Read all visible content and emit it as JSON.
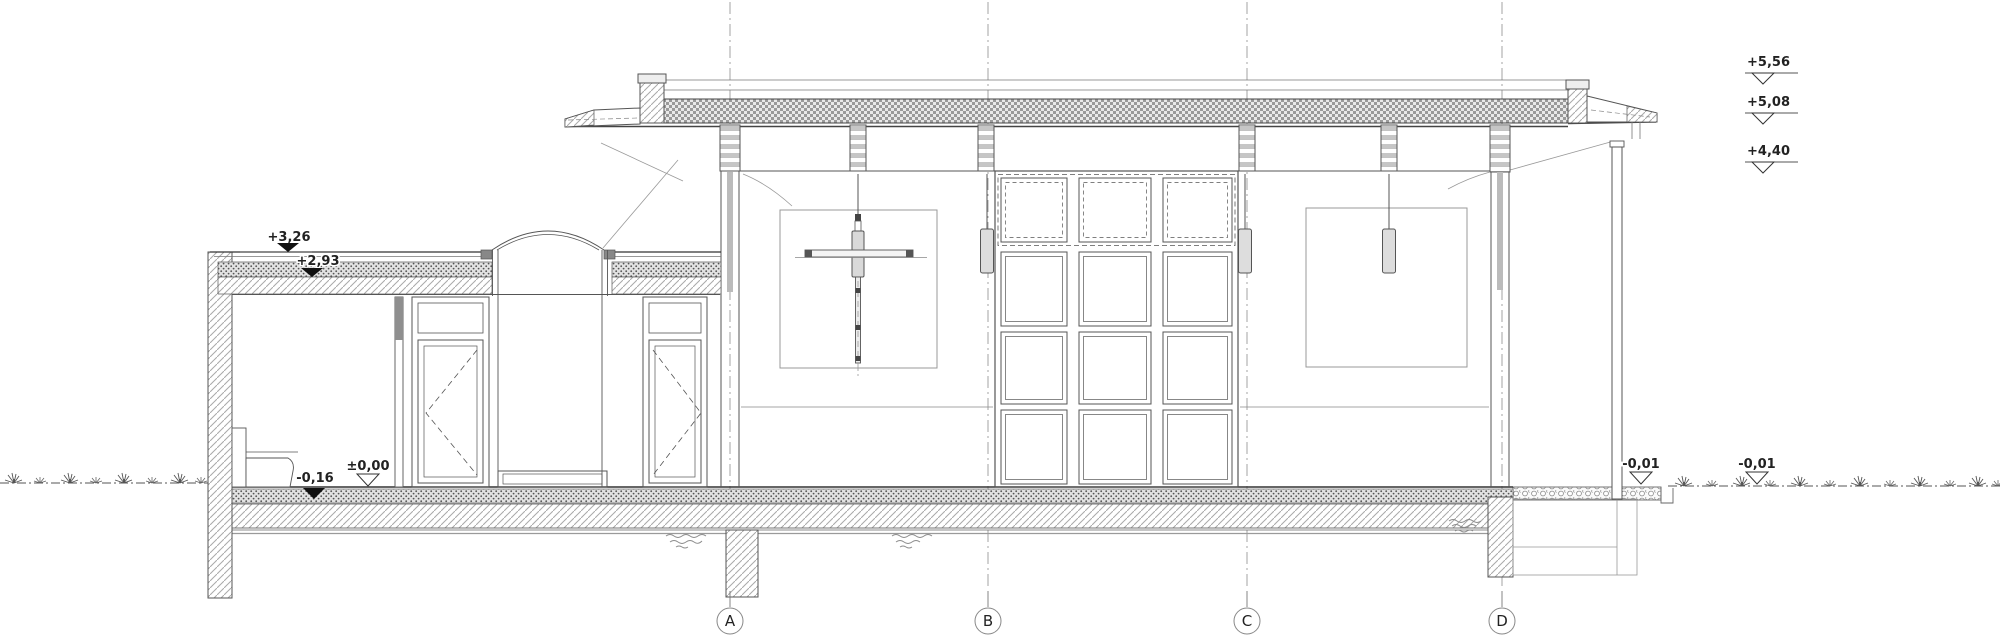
{
  "drawing": {
    "kind": "architectural-section",
    "grid": {
      "axes": [
        {
          "label": "A"
        },
        {
          "label": "B"
        },
        {
          "label": "C"
        },
        {
          "label": "D"
        }
      ]
    },
    "levels": {
      "right_margin": [
        {
          "label": "+5,56"
        },
        {
          "label": "+5,08"
        },
        {
          "label": "+4,40"
        }
      ],
      "annex_roof": [
        {
          "label": "+3,26"
        },
        {
          "label": "+2,93"
        }
      ],
      "floor": [
        {
          "label": "±0,00"
        },
        {
          "label": "-0,16"
        }
      ],
      "ground": [
        {
          "label": "-0,01"
        },
        {
          "label": "-0,01"
        }
      ]
    }
  }
}
